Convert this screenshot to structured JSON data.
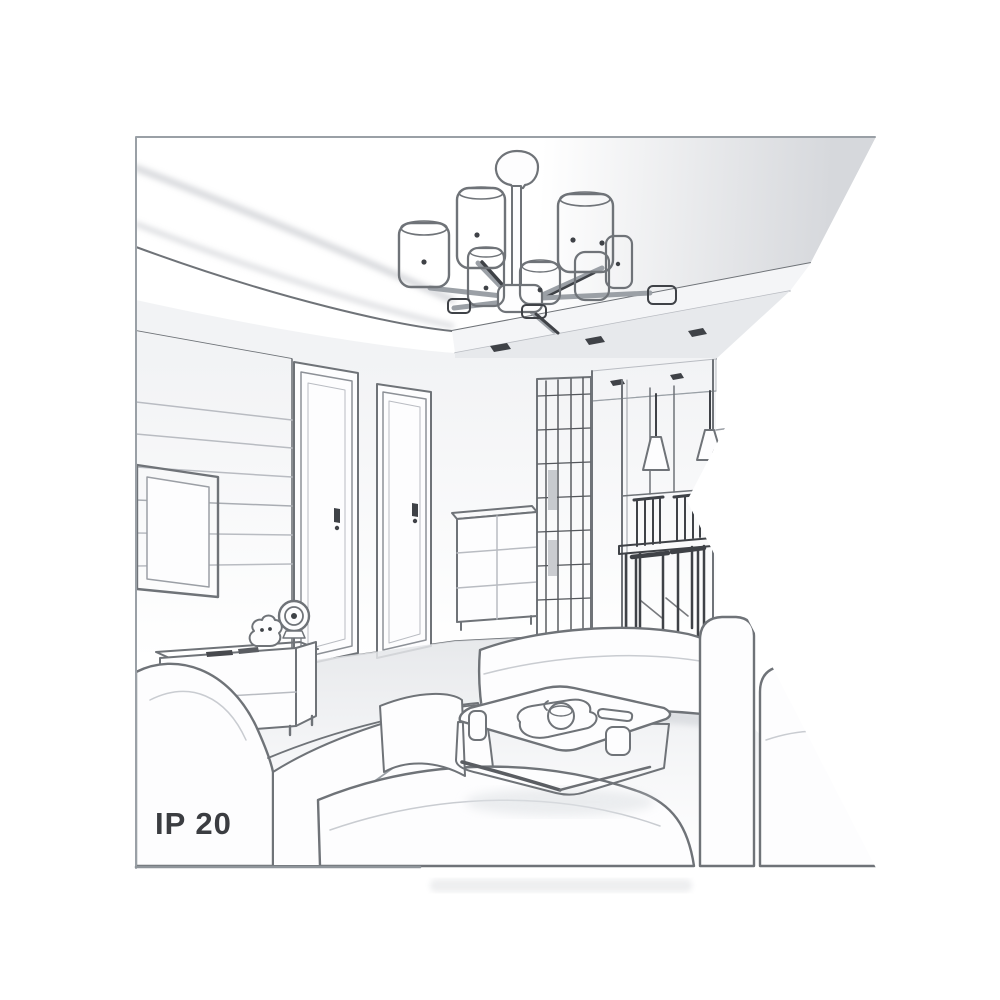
{
  "page": {
    "background_color": "#ffffff"
  },
  "illustration": {
    "caption": "IP 20",
    "type": "grayscale line-art interior rendering, pentagon (notched flag) crop",
    "scene": "living room with 6-shade ceiling chandelier, tray ceiling with recessed spots, slatted TV wall with television and lowboard, two interior doors, drawer chest, grid-front wardrobe, hallway with cone pendant lamps and dining table with chairs, sectional sofas and white coffee table with tea tray, cups and remote",
    "colors": {
      "background": "#ffffff",
      "frame_border": "#9aa0a6",
      "line": "#6f7378",
      "line_dark": "#3f4247",
      "line_soft": "#b9bcc2",
      "fill_white": "#fdfdfe",
      "shade_light": "#e7e9ec",
      "shade_mid": "#d8dade",
      "fascia": "#f4f5f7",
      "text": "#3b3d41",
      "shadow": "#e9eaec"
    },
    "objects": [
      "ceiling-chandelier",
      "ceiling-recessed-spotlights",
      "tray-ceiling",
      "tv-wall-panelling",
      "television",
      "tv-lowboard",
      "round-speaker",
      "figurine",
      "interior-door-left",
      "interior-door-right",
      "drawer-chest",
      "grid-wardrobe",
      "hallway",
      "cone-pendant-lamps",
      "dining-table",
      "dining-chairs",
      "left-sofa",
      "right-sofa-armrests",
      "ottoman-seat",
      "coffee-table",
      "tea-tray-with-pot",
      "cups",
      "remote-control"
    ]
  }
}
